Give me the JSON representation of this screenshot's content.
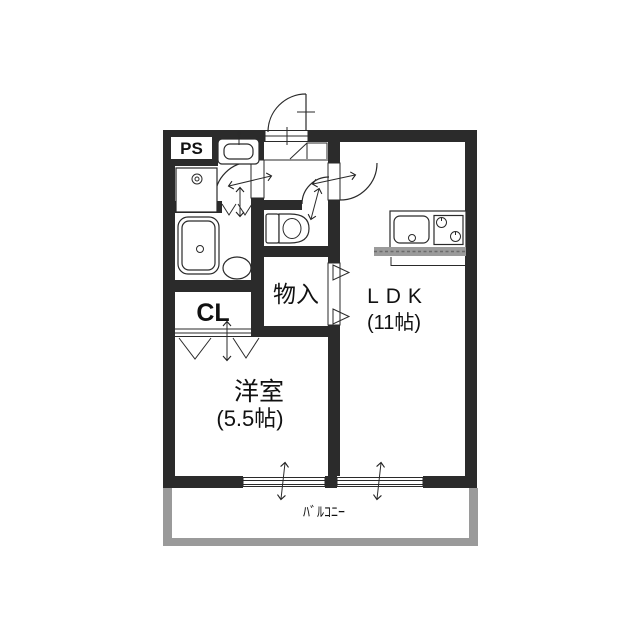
{
  "floorplan": {
    "rooms": {
      "pipe_space": {
        "name": "PS"
      },
      "closet": {
        "name": "CL"
      },
      "storage": {
        "name": "物入"
      },
      "ldk": {
        "name": "LDK",
        "size": "(11帖)"
      },
      "western": {
        "name": "洋室",
        "size": "(5.5帖)"
      },
      "balcony": {
        "name": "ﾊﾞﾙｺﾆｰ"
      }
    },
    "colors": {
      "wall": "#2b2b2b",
      "line": "#2a2a2a",
      "balcony": "#9a9a9a",
      "counter_hatch": "#9b9b9b",
      "text": "#111111",
      "background": "#ffffff"
    }
  }
}
